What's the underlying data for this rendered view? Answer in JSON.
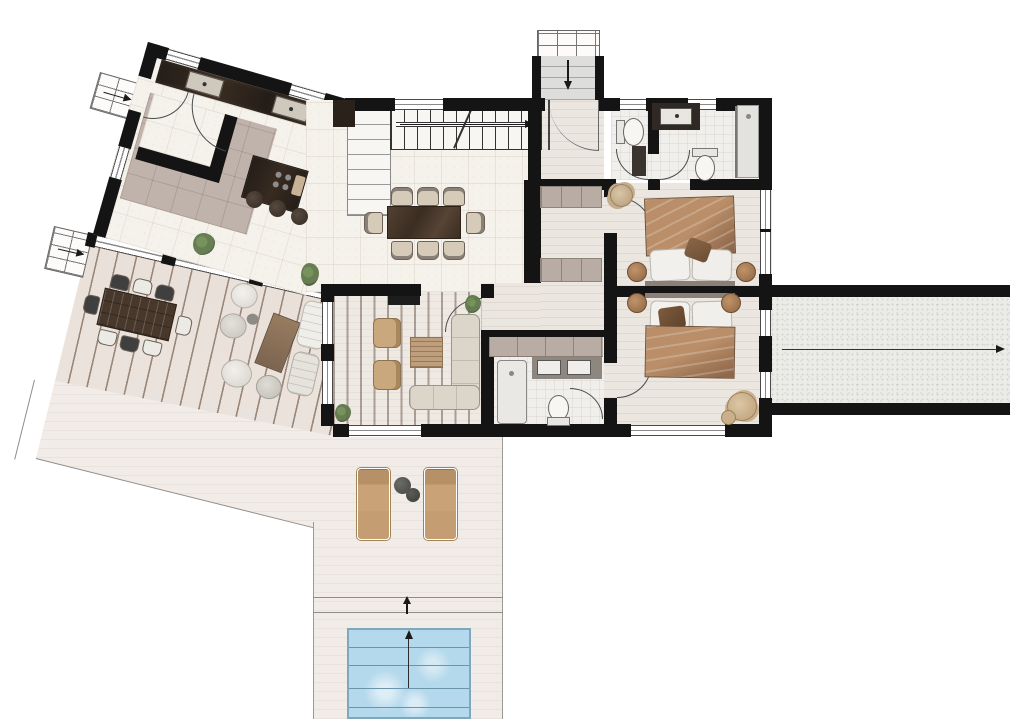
{
  "meta": {
    "type": "residential-floor-plan",
    "view": "top-down-rendered-plan",
    "visible_text_labels": [],
    "wings": [
      "angled-kitchen-dining-wing",
      "orthogonal-bedroom-wing",
      "outdoor-deck-patio-pool"
    ]
  },
  "colors": {
    "wall": "#141414",
    "tile_floor": "#f5f2ec",
    "plank_floor": "#ece6e1",
    "deck": "#eae0d8",
    "deck_line": "#9b8777",
    "patio": "#f2ece8",
    "pool_water": "#b5d9ec",
    "pool_line": "#6b95aa",
    "dark_wood": "#48382c",
    "kitchen_counter": "#271f19",
    "tan_fabric": "#c9a377",
    "duvet_light": "#b98e68",
    "duvet_dark": "#8a6347",
    "wardrobe": "#c0b3ab",
    "sofa": "#dcd5ca",
    "plant_green": "#5a7444",
    "gravel": "#ebebe8",
    "arrow": "#1a1a1a"
  },
  "rooms": [
    {
      "id": "kitchen",
      "features": [
        "counter-with-two-sinks",
        "island-with-cooktop-and-board",
        "three-bar-stools",
        "pantry-nook-with-l-wall",
        "two-interior-doors",
        "plant"
      ]
    },
    {
      "id": "dining-area",
      "features": [
        "dark-wood-table",
        "eight-chairs",
        "corner-plant"
      ]
    },
    {
      "id": "stair-hall",
      "features": [
        "straight-stair-run",
        "winder-landing",
        "direction-arrow-right"
      ]
    },
    {
      "id": "entry",
      "features": [
        "front-door-swing",
        "exterior-entry-steps",
        "arrow-down"
      ]
    },
    {
      "id": "guest-wc",
      "features": [
        "toilet",
        "dark-vanity"
      ]
    },
    {
      "id": "main-bathroom",
      "features": [
        "vanity-counter-with-basin",
        "toilet",
        "walk-in-shower-with-glass"
      ]
    },
    {
      "id": "hallway",
      "features": [
        "built-in-wardrobe-upper",
        "built-in-wardrobe-lower"
      ]
    },
    {
      "id": "bedroom-1",
      "features": [
        "double-bed-brown-duvet",
        "two-white-pillows",
        "accent-pillow",
        "two-round-nightstands",
        "round-pouf",
        "tall-east-window"
      ]
    },
    {
      "id": "bedroom-2",
      "features": [
        "double-bed-brown-duvet",
        "two-white-pillows",
        "accent-pillow",
        "two-round-lamps",
        "reading-chair-with-ottoman",
        "two-east-windows",
        "south-window"
      ]
    },
    {
      "id": "ensuite-bathroom",
      "features": [
        "shower-cabin",
        "double-basin-counter",
        "toilet",
        "door-swing",
        "built-in-wardrobe"
      ]
    },
    {
      "id": "living-room",
      "features": [
        "slatted-beam-ceiling",
        "tv-on-north-wall",
        "two-tan-armchairs",
        "slatted-coffee-table",
        "l-shaped-sofa",
        "two-corner-plants",
        "west-windows",
        "south-slider"
      ]
    }
  ],
  "outdoor": [
    {
      "id": "wood-deck",
      "features": [
        "diagonal-plank-decking",
        "outdoor-dining-table",
        "eight-mixed-chairs",
        "lounge-group-with-wood-table",
        "two-chaises"
      ]
    },
    {
      "id": "patio",
      "features": [
        "two-tan-sun-loungers",
        "two-round-dark-side-tables",
        "thin-boundary-outline"
      ]
    },
    {
      "id": "pool",
      "features": [
        "light-blue-water",
        "lane-grid-lines",
        "center-line",
        "up-arrow"
      ]
    },
    {
      "id": "driveway",
      "features": [
        "gravel-texture",
        "black-side-walls",
        "long-arrow-to-right-edge"
      ]
    },
    {
      "id": "entry-steps",
      "features": [
        "open-upper-steps",
        "walled-lower-steps",
        "down-arrow"
      ]
    },
    {
      "id": "side-steps-upper",
      "features": [
        "step-grid",
        "arrow-right-into-side-door"
      ]
    },
    {
      "id": "side-steps-lower",
      "features": [
        "step-grid",
        "arrow-right-onto-deck"
      ]
    }
  ],
  "arrows": [
    {
      "id": "entry-steps-arrow",
      "direction": "down"
    },
    {
      "id": "interior-stair-arrow",
      "direction": "right"
    },
    {
      "id": "side-steps-upper-arrow",
      "direction": "right"
    },
    {
      "id": "side-steps-lower-arrow",
      "direction": "right"
    },
    {
      "id": "driveway-arrow",
      "direction": "right"
    },
    {
      "id": "patio-arrow",
      "direction": "up"
    },
    {
      "id": "pool-arrow",
      "direction": "up"
    }
  ]
}
